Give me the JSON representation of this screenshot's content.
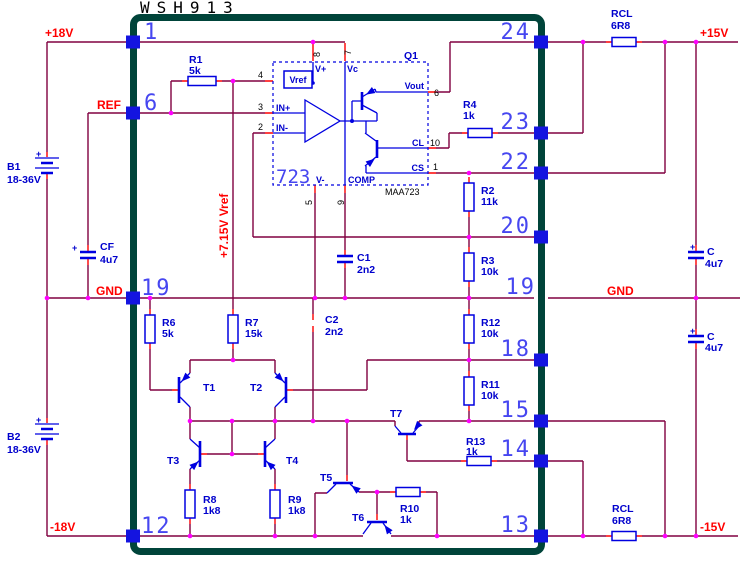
{
  "schematic": {
    "module": {
      "title": "WSH913",
      "pins_left": [
        "1",
        "6",
        "19",
        "12"
      ],
      "pins_right": [
        "24",
        "23",
        "22",
        "20",
        "19",
        "18",
        "15",
        "14",
        "13"
      ]
    },
    "nets": {
      "plus18": "+18V",
      "ref": "REF",
      "gnd_left": "GND",
      "gnd_right": "GND",
      "minus18": "-18V",
      "plus15": "+15V",
      "minus15": "-15V",
      "vref_rail": "+7.15V Vref"
    },
    "ic723": {
      "big_label": "723",
      "part": "MAA723",
      "group": "Q1",
      "pads": {
        "vref": "Vref",
        "vplus": "V+",
        "vc": "Vc",
        "vout": "Vout",
        "cl": "CL",
        "cs": "CS",
        "comp": "COMP",
        "vminus": "V-",
        "inp": "IN+",
        "inn": "IN-"
      },
      "pins": {
        "p4": "4",
        "p3": "3",
        "p2": "2",
        "p8": "8",
        "p7": "7",
        "p6": "6",
        "p10": "10",
        "p1": "1",
        "p5": "5",
        "p9": "9"
      }
    },
    "components": {
      "b1": {
        "ref": "B1",
        "value": "18-36V",
        "polarity": "+"
      },
      "b2": {
        "ref": "B2",
        "value": "18-36V",
        "polarity": "+"
      },
      "cf": {
        "ref": "CF",
        "value": "4u7",
        "polarity": "+"
      },
      "c_top": {
        "ref": "C",
        "value": "4u7",
        "polarity": "+"
      },
      "c_bot": {
        "ref": "C",
        "value": "4u7",
        "polarity": "+"
      },
      "rcl_top": {
        "ref": "RCL",
        "value": "6R8"
      },
      "rcl_bot": {
        "ref": "RCL",
        "value": "6R8"
      },
      "r1": {
        "ref": "R1",
        "value": "5k"
      },
      "r2": {
        "ref": "R2",
        "value": "11k"
      },
      "r3": {
        "ref": "R3",
        "value": "10k"
      },
      "r4": {
        "ref": "R4",
        "value": "1k"
      },
      "r6": {
        "ref": "R6",
        "value": "5k"
      },
      "r7": {
        "ref": "R7",
        "value": "15k"
      },
      "r8": {
        "ref": "R8",
        "value": "1k8"
      },
      "r9": {
        "ref": "R9",
        "value": "1k8"
      },
      "r10": {
        "ref": "R10",
        "value": "1k"
      },
      "r11": {
        "ref": "R11",
        "value": "10k"
      },
      "r12": {
        "ref": "R12",
        "value": "10k"
      },
      "r13": {
        "ref": "R13",
        "value": "1k"
      },
      "t1": {
        "ref": "T1"
      },
      "t2": {
        "ref": "T2"
      },
      "t3": {
        "ref": "T3"
      },
      "t4": {
        "ref": "T4"
      },
      "t5": {
        "ref": "T5"
      },
      "t6": {
        "ref": "T6"
      },
      "t7": {
        "ref": "T7"
      }
    },
    "colors": {
      "wire": "#800040",
      "lead": "#fe0000",
      "component": "#0000e0",
      "junction": "#ff00ff",
      "net_label": "#ff0000",
      "pin_number": "#4646f0",
      "module_border": "#00443a"
    }
  }
}
